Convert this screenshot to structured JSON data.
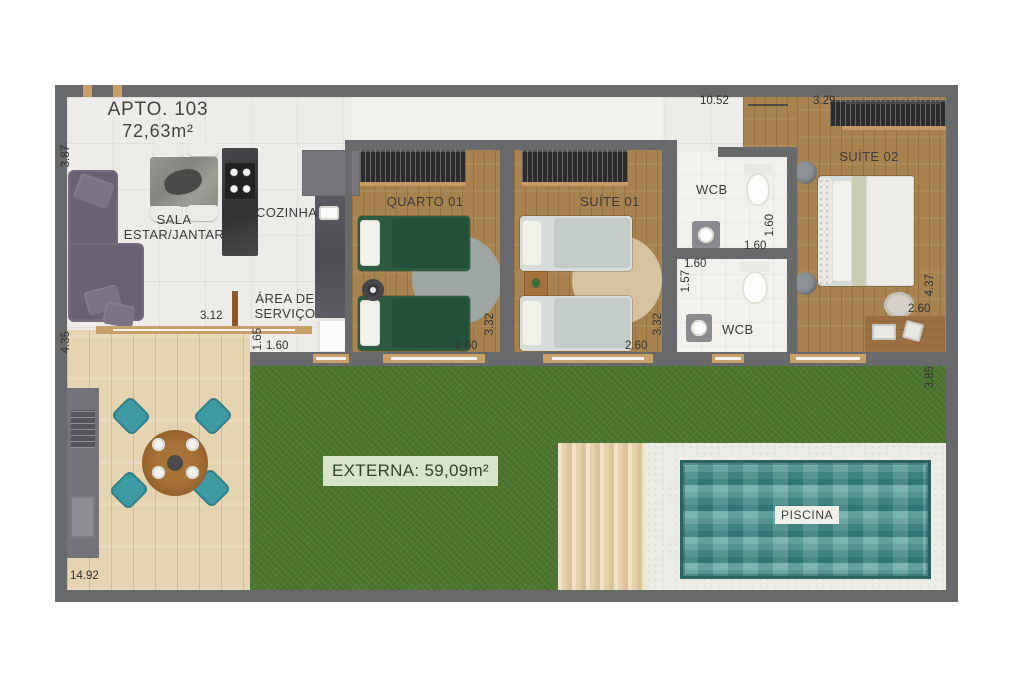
{
  "meta": {
    "type": "apartment-floor-plan"
  },
  "labels": {
    "title": "APTO. 103",
    "area_total": "72,63m²",
    "sala_line1": "SALA",
    "sala_line2": "ESTAR/JANTAR",
    "cozinha": "COZINHA",
    "servico_line1": "ÁREA DE",
    "servico_line2": "SERVIÇO",
    "quarto01": "QUARTO 01",
    "suite01": "SUÍTE 01",
    "wcb_top": "WCB",
    "wcb_bottom": "WCB",
    "suite02": "SUÍTE 02",
    "externa": "EXTERNA: 59,09m²",
    "piscina": "PISCINA"
  },
  "dimensions": {
    "sala_height": "3.87",
    "deck_height": "4.35",
    "bottom_width": "14.92",
    "sala_width": "3.12",
    "servico_height": "1.65",
    "servico_width": "1.60",
    "quarto01_width": "2.60",
    "quarto01_depth": "3.32",
    "suite01_width": "2.60",
    "suite01_depth": "3.32",
    "wcb_top_height": "1.60",
    "wcb_top_width": "1.60",
    "wcb_bottom_width": "1.60",
    "wcb_bottom_height": "1.57",
    "suite02_depth": "4.37",
    "suite02_width_bottom": "2.60",
    "garden_right_height": "3.85",
    "top_width_main": "10.52",
    "top_width_suite02": "3.29"
  },
  "colors": {
    "wall": "#68696b",
    "tile": "#edece8",
    "wood": "#a8834f",
    "deck": "#e6d3b0",
    "grass": "#4e7830",
    "pool": "#3f8b88",
    "pool_deck": "#e7d5b2",
    "surround": "#edede7",
    "sofa": "#6a6175",
    "bed_green": "#2c5c3f",
    "bed_light": "#d5dbda",
    "chair_teal": "#3d9aa3",
    "externa_badge": "#d9e5ca",
    "text": "#3a3a3a"
  }
}
